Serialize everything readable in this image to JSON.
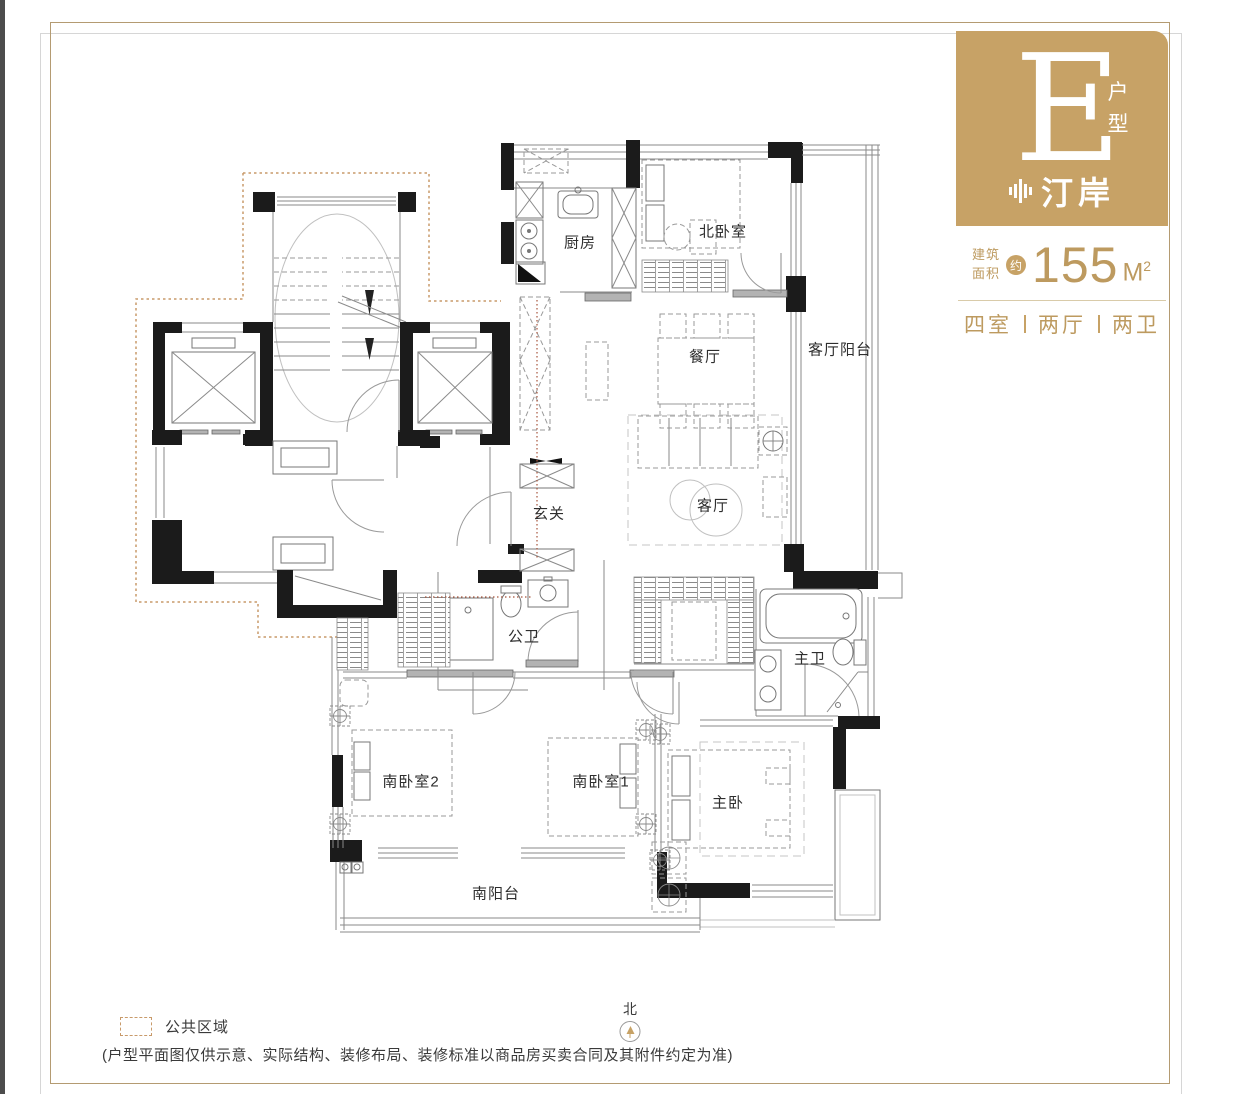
{
  "unit_card": {
    "letter": "E",
    "letter_suffix": "户型",
    "brand": "汀岸",
    "area_label_top": "建筑",
    "area_label_bottom": "面积",
    "area_approx": "约",
    "area_value": "155",
    "area_unit": "M",
    "area_unit_exp": "2",
    "layout_parts": [
      "四室",
      "两厅",
      "两卫"
    ]
  },
  "rooms": {
    "kitchen": "厨房",
    "north_bedroom": "北卧室",
    "dining": "餐厅",
    "living_balcony": "客厅阳台",
    "living": "客厅",
    "foyer": "玄关",
    "public_bath": "公卫",
    "master_bath": "主卫",
    "south_bedroom_2": "南卧室2",
    "south_bedroom_1": "南卧室1",
    "master_bedroom": "主卧",
    "south_balcony": "南阳台"
  },
  "legend": {
    "public_area": "公共区域"
  },
  "compass": {
    "north": "北"
  },
  "footnote": "(户型平面图仅供示意、实际结构、装修布局、装修标准以商品房买卖合同及其附件约定为准)",
  "colors": {
    "accent_gold": "#c7a266",
    "wall_black": "#1b1b1b",
    "public_area_dash": "#c89a6a",
    "guide_red": "#a6543c"
  }
}
